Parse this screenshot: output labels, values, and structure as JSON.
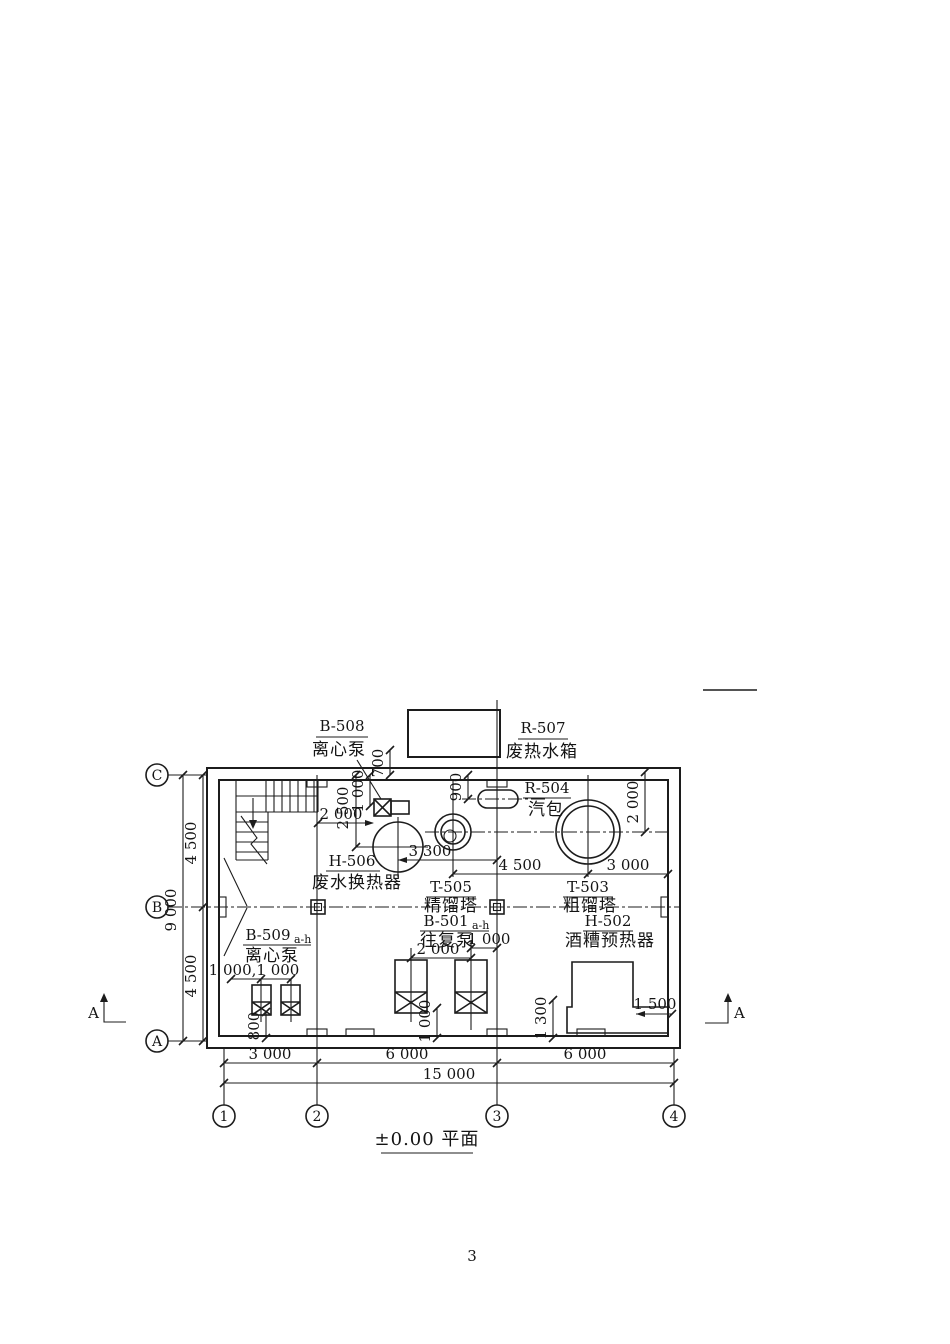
{
  "title": {
    "text": "±0.00 平面"
  },
  "page": {
    "number": "3"
  },
  "grid": {
    "rows": [
      "C",
      "B",
      "A"
    ],
    "cols": [
      "1",
      "2",
      "3",
      "4"
    ]
  },
  "section": {
    "label": "A"
  },
  "equipment": {
    "b508": {
      "tag": "B-508",
      "name": "离心泵"
    },
    "r507": {
      "tag": "R-507",
      "name": "废热水箱"
    },
    "r504": {
      "tag": "R-504",
      "name": "汽包"
    },
    "h506": {
      "tag": "H-506",
      "name": "废水换热器"
    },
    "t505": {
      "tag": "T-505",
      "name": "精馏塔"
    },
    "b501": {
      "tag": "B-501",
      "suffix": "a-h",
      "name": "往复泵"
    },
    "t503": {
      "tag": "T-503",
      "name": "粗馏塔"
    },
    "h502": {
      "tag": "H-502",
      "name": "酒糟预热器"
    },
    "b509": {
      "tag": "B-509",
      "suffix": "a-h",
      "name": "离心泵"
    }
  },
  "dims": {
    "v700": "700",
    "v2500": "2 500",
    "v1000_b508": "1 000",
    "h2000_b508": "2 000",
    "v900": "900",
    "v2000_t503": "2 000",
    "h3300": "3 300",
    "h4500_mid": "4 500",
    "h3000_mid": "3 000",
    "h2000_b501": "2 000",
    "h1000_b501": "1 000",
    "v1000_b501": "1 000",
    "h1000x2_b509": "1 000,1 000",
    "v800": "800",
    "v1300": "1 300",
    "h1500": "1 500",
    "left_upper": "4 500",
    "left_lower": "4 500",
    "left_total": "9 000",
    "bot_1": "3 000",
    "bot_2": "6 000",
    "bot_3": "6 000",
    "bot_total": "15 000"
  }
}
